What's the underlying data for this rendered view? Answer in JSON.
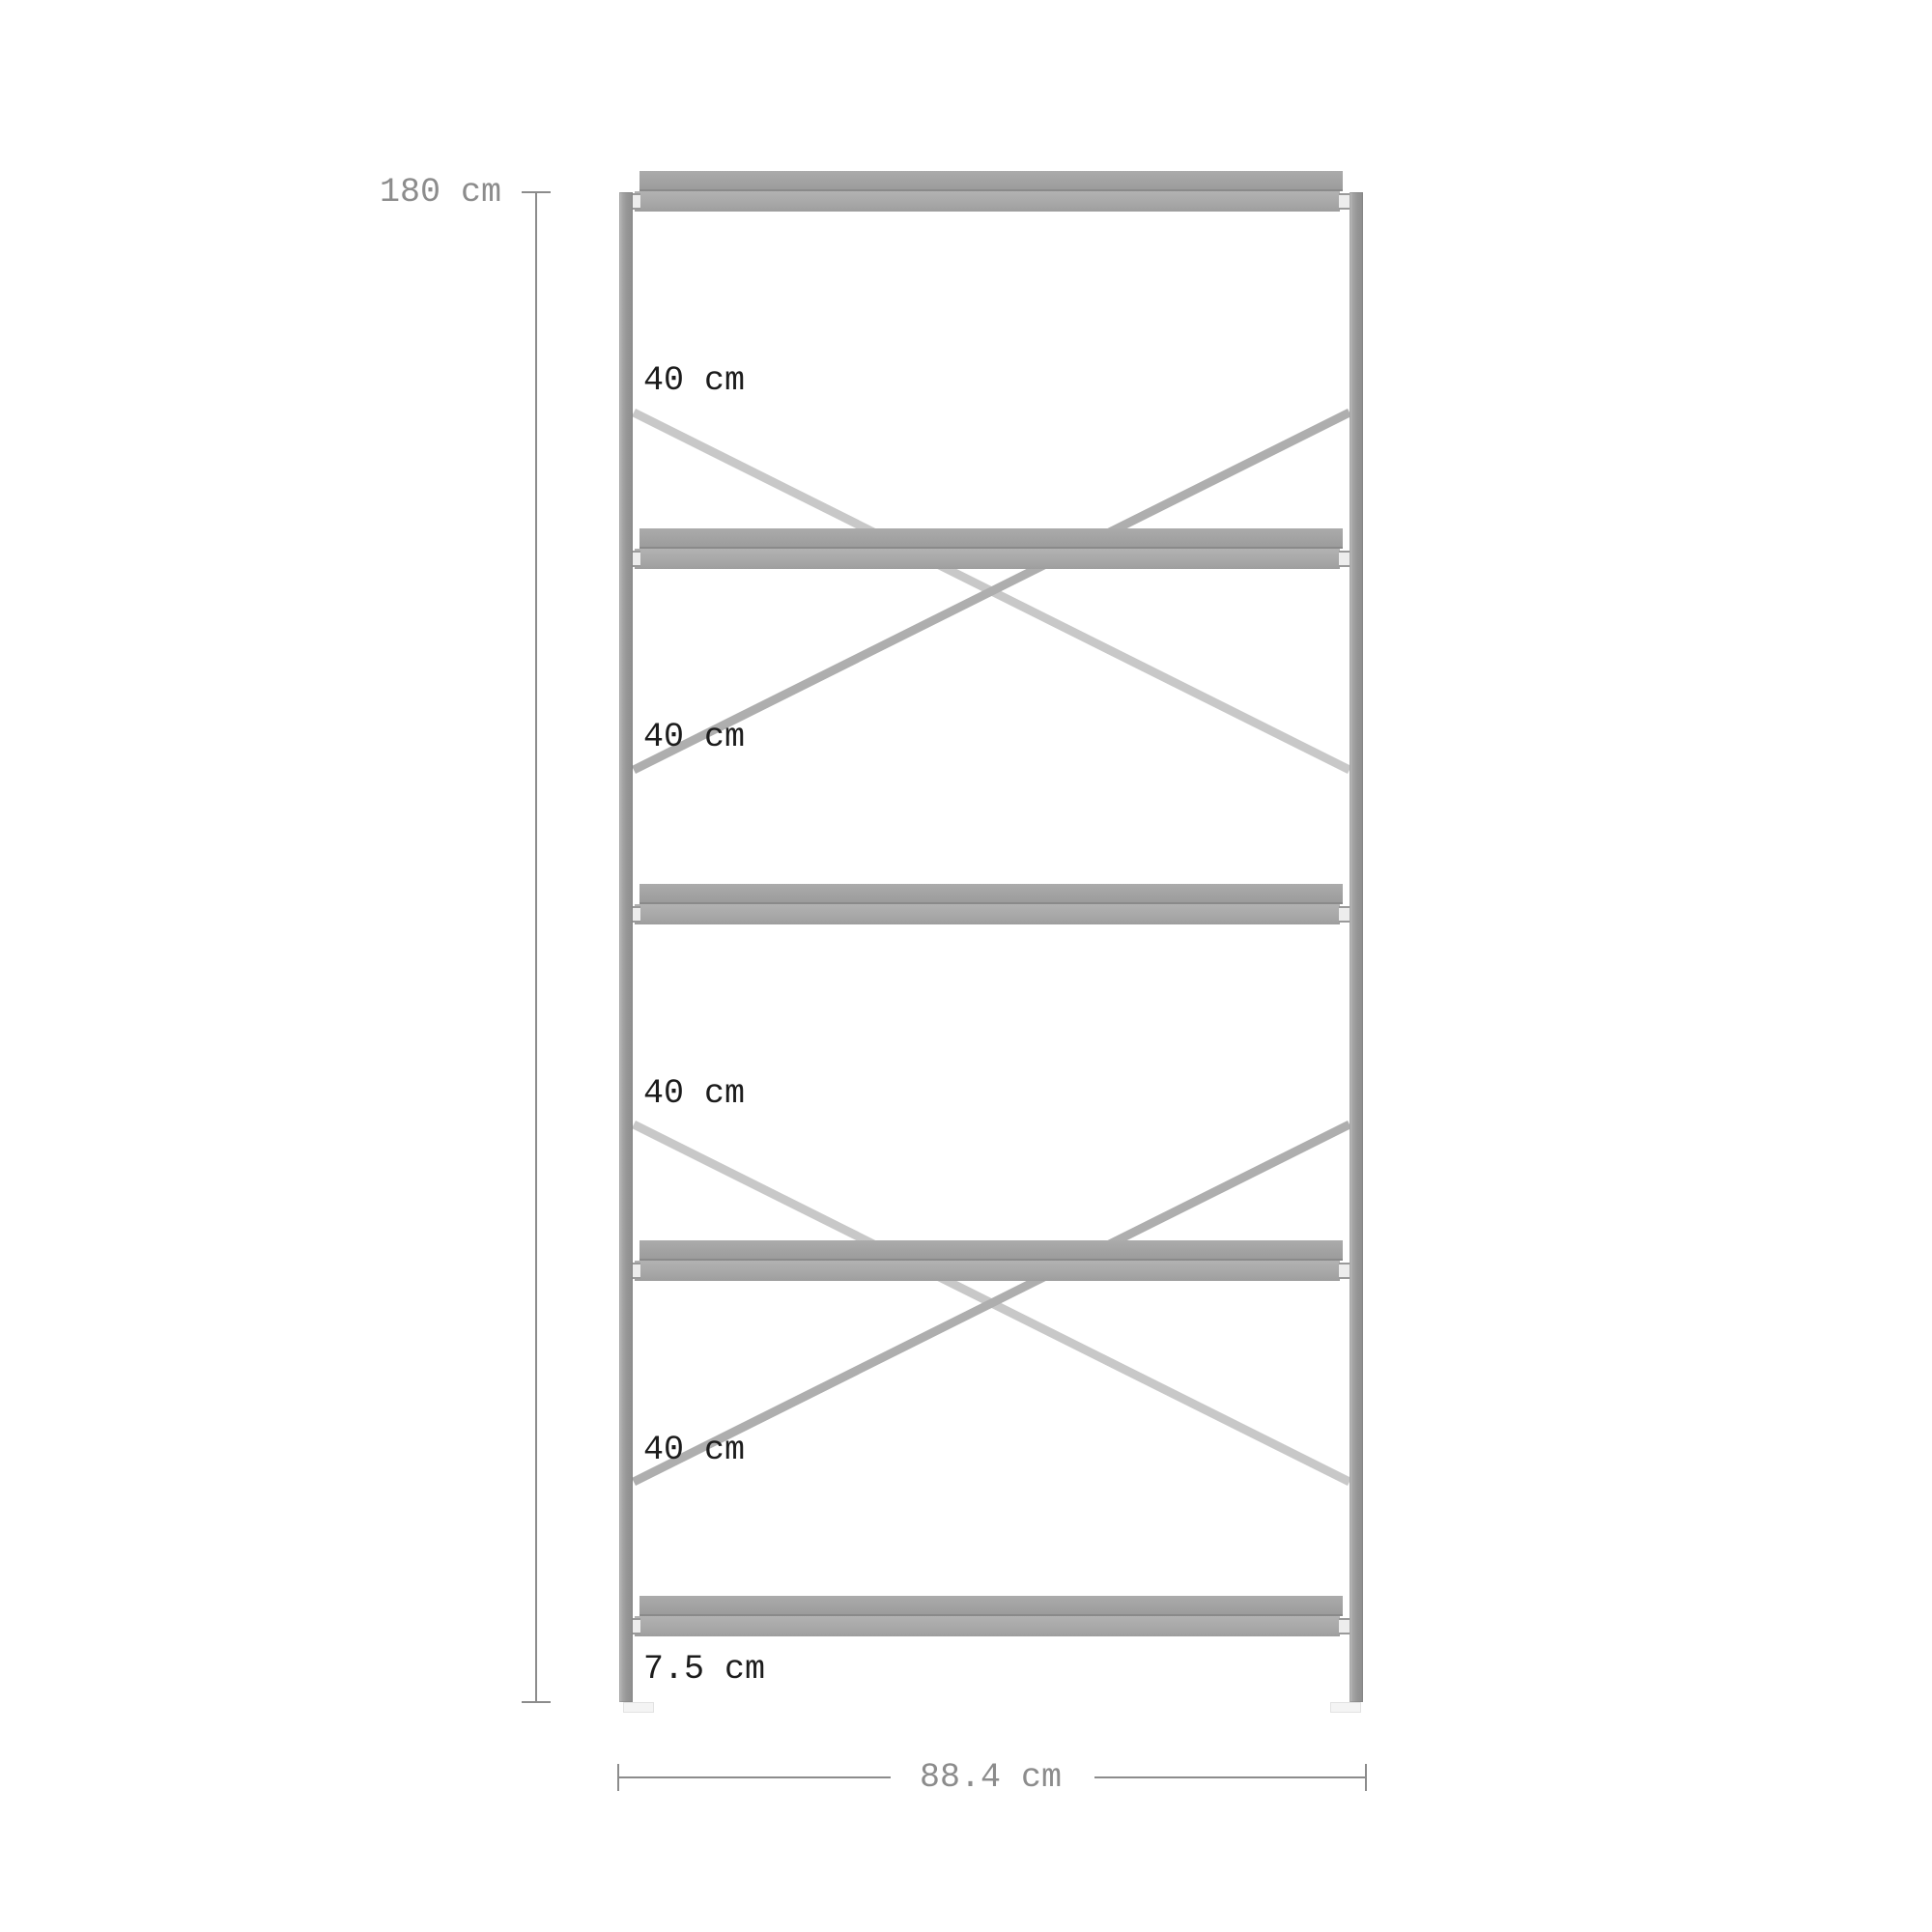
{
  "diagram": {
    "subject": "shelving-unit-front-elevation",
    "shelf_count": 5,
    "labels": {
      "height": "180 cm",
      "width": "88.4 cm",
      "sections": [
        "40 cm",
        "40 cm",
        "40 cm",
        "40 cm"
      ],
      "bottom_gap": "7.5 cm"
    },
    "colors": {
      "background": "#ffffff",
      "frame_post": "#969696",
      "shelf_cap": "#a2a2a2",
      "shelf_beam": "#a8a8a8",
      "brace_back": "#c8c8c8",
      "brace_front": "#aeaeae",
      "dimension_line": "#8c8c8c",
      "dimension_text_gray": "#8c8c8c",
      "section_label_text": "#1c1c1c"
    }
  }
}
